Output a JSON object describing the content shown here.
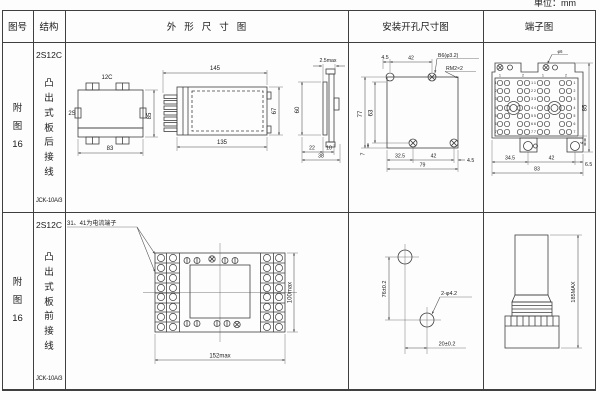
{
  "page": {
    "unit_label": "单位：mm"
  },
  "table": {
    "headers": {
      "figure_no": "图号",
      "structure": "结构",
      "outline": "外形尺寸图",
      "mounting": "安装开孔尺寸图",
      "terminal": "端子图"
    }
  },
  "rows": [
    {
      "figure_no": "附图16",
      "structure": {
        "model": "2S12C",
        "desc": "凸出式板后接线",
        "type": "JCK-10A/3"
      },
      "outline": {
        "front": {
          "top_label": "12C",
          "left_label": "2S",
          "width": "83",
          "height": "85"
        },
        "side": {
          "top_width": "145",
          "bottom_width": "135",
          "height": "67"
        },
        "flange": {
          "thickness": "2.5max",
          "height": "60",
          "dim_a": "22",
          "dim_b": "10",
          "dim_total": "38"
        }
      },
      "mounting": {
        "top_dim_a": "4.5",
        "top_dim_b": "42",
        "hole_label": "B6(φ3.2)",
        "thread_label": "RM2×2",
        "left_dim_outer": "77",
        "left_dim_inner": "63",
        "bottom_left": "7",
        "bottom_dim_a": "32.5",
        "bottom_dim_b": "42",
        "bottom_dim_c": "4.5",
        "bottom_total": "79"
      },
      "terminal": {
        "top_label": "φ6",
        "col_labels": [
          "1",
          "2",
          "1",
          "2"
        ],
        "row_numbers": [
          "1",
          "2",
          "3",
          "4",
          "5",
          "6",
          "7"
        ],
        "pair_numbers": [
          "1 1",
          "2 2",
          "3 3",
          "4 4",
          "5 5",
          "6 6",
          "7 7"
        ],
        "height": "85",
        "side_dim": "4",
        "bottom_dim_a": "34.5",
        "bottom_dim_b": "42",
        "bottom_dim_c": "6.5",
        "bottom_total": "83"
      }
    },
    {
      "figure_no": "附图16",
      "structure": {
        "model": "2S12C",
        "desc": "凸出式板前接线",
        "type": "JCK-10A/3"
      },
      "outline": {
        "note": "31、41为电流端子",
        "width": "152max",
        "height": "100max"
      },
      "mounting": {
        "vertical_dim": "76±0.2",
        "horizontal_dim": "20±0.2",
        "hole_label": "2-φ4.2"
      },
      "terminal": {
        "height": "185MAX"
      }
    }
  ]
}
